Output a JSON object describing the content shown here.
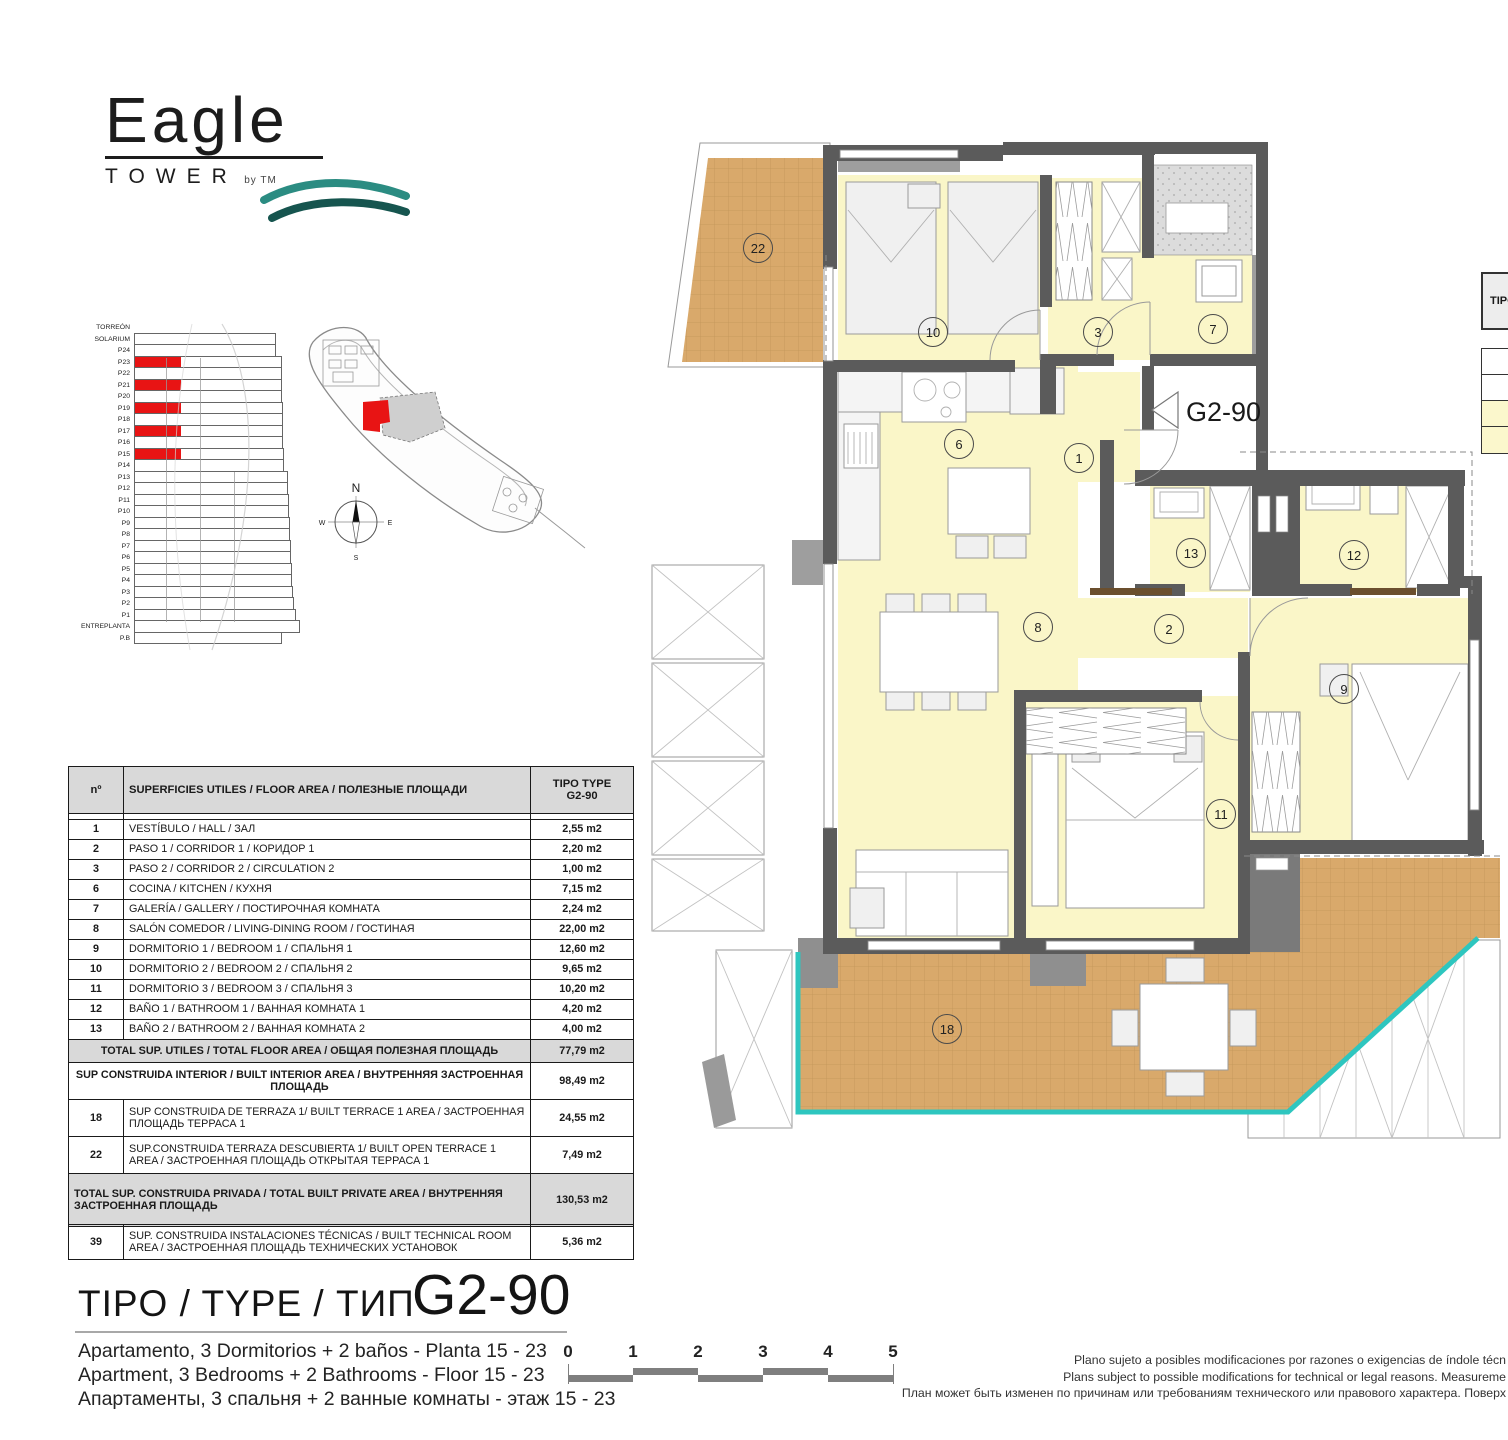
{
  "logo": {
    "name": "Eagle",
    "sub": "TOWER",
    "by": "by TM"
  },
  "elevation": {
    "floors": [
      {
        "label": "TORREÓN",
        "red": false
      },
      {
        "label": "SOLARIUM",
        "red": false
      },
      {
        "label": "P24",
        "red": false
      },
      {
        "label": "P23",
        "red": true
      },
      {
        "label": "P22",
        "red": false
      },
      {
        "label": "P21",
        "red": true
      },
      {
        "label": "P20",
        "red": false
      },
      {
        "label": "P19",
        "red": true
      },
      {
        "label": "P18",
        "red": false
      },
      {
        "label": "P17",
        "red": true
      },
      {
        "label": "P16",
        "red": false
      },
      {
        "label": "P15",
        "red": true
      },
      {
        "label": "P14",
        "red": false
      },
      {
        "label": "P13",
        "red": false
      },
      {
        "label": "P12",
        "red": false
      },
      {
        "label": "P11",
        "red": false
      },
      {
        "label": "P10",
        "red": false
      },
      {
        "label": "P9",
        "red": false
      },
      {
        "label": "P8",
        "red": false
      },
      {
        "label": "P7",
        "red": false
      },
      {
        "label": "P6",
        "red": false
      },
      {
        "label": "P5",
        "red": false
      },
      {
        "label": "P4",
        "red": false
      },
      {
        "label": "P3",
        "red": false
      },
      {
        "label": "P2",
        "red": false
      },
      {
        "label": "P1",
        "red": false
      },
      {
        "label": "ENTREPLANTA",
        "red": false
      },
      {
        "label": "P.B",
        "red": false
      }
    ]
  },
  "site": {
    "compass": {
      "n": "N",
      "e": "E",
      "s": "S",
      "w": "W"
    }
  },
  "area_table": {
    "col_no": "nº",
    "col_desc": "SUPERFICIES UTILES / FLOOR AREA / ПОЛЕЗНЫЕ ПЛОЩАДИ",
    "col_type": "TIPO TYPE",
    "col_type2": "G2-90",
    "rows": [
      {
        "no": "1",
        "desc": "VESTÍBULO / HALL / ЗАЛ",
        "val": "2,55 m2"
      },
      {
        "no": "2",
        "desc": "PASO 1 /  CORRIDOR 1 / КОРИДОР 1",
        "val": "2,20 m2"
      },
      {
        "no": "3",
        "desc": "PASO 2 / CORRIDOR 2 / CIRCULATION 2",
        "val": "1,00 m2"
      },
      {
        "no": "6",
        "desc": "COCINA / KITCHEN / КУХНЯ",
        "val": "7,15 m2"
      },
      {
        "no": "7",
        "desc": "GALERÍA / GALLERY / ПОСТИРОЧНАЯ КОМНАТА",
        "val": "2,24 m2"
      },
      {
        "no": "8",
        "desc": "SALÓN COMEDOR  / LIVING-DINING ROOM / ГОСТИНАЯ",
        "val": "22,00 m2"
      },
      {
        "no": "9",
        "desc": "DORMITORIO 1 / BEDROOM 1 / СПАЛЬНЯ 1",
        "val": "12,60 m2"
      },
      {
        "no": "10",
        "desc": "DORMITORIO 2 / BEDROOM 2 / СПАЛЬНЯ 2",
        "val": "9,65 m2"
      },
      {
        "no": "11",
        "desc": "DORMITORIO 3 / BEDROOM 3 / СПАЛЬНЯ 3",
        "val": "10,20 m2"
      },
      {
        "no": "12",
        "desc": "BAÑO 1 / BATHROOM 1 / ВАННАЯ КОМНАТА 1",
        "val": "4,20 m2"
      },
      {
        "no": "13",
        "desc": "BAÑO 2 / BATHROOM 2 / ВАННАЯ КОМНАТА 2",
        "val": "4,00 m2"
      }
    ],
    "total_utiles": {
      "desc": "TOTAL SUP. UTILES / TOTAL FLOOR AREA / ОБЩАЯ ПОЛЕЗНАЯ ПЛОЩАДЬ",
      "val": "77,79 m2"
    },
    "interior": {
      "desc": "SUP CONSTRUIDA INTERIOR / BUILT INTERIOR AREA / ВНУТРЕННЯЯ ЗАСТРОЕННАЯ ПЛОЩАДЬ",
      "val": "98,49 m2"
    },
    "terrace_rows": [
      {
        "no": "18",
        "desc": "SUP CONSTRUIDA DE TERRAZA 1/ BUILT TERRACE 1 AREA / ЗАСТРОЕННАЯ ПЛОЩАДЬ ТЕРРАСА  1",
        "val": "24,55 m2"
      },
      {
        "no": "22",
        "desc": "SUP.CONSTRUIDA TERRAZA DESCUBIERTA 1/ BUILT OPEN TERRACE 1 AREA / ЗАСТРОЕННАЯ ПЛОЩАДЬ ОТКРЫТАЯ ТЕРРАСА  1",
        "val": "7,49 m2"
      }
    ],
    "total_privada": {
      "desc": "TOTAL SUP. CONSTRUIDA PRIVADA / TOTAL  BUILT PRIVATE AREA / ВНУТРЕННЯЯ ЗАСТРОЕННАЯ ПЛОЩАДЬ",
      "val": "130,53 m2"
    },
    "technical": {
      "no": "39",
      "desc": "SUP. CONSTRUIDA INSTALACIONES TÉCNICAS / BUILT TECHNICAL ROOM AREA / ЗАСТРОЕННАЯ ПЛОЩАДЬ ТЕХНИЧЕСКИХ УСТАНОВОК",
      "val": "5,36 m2"
    }
  },
  "plan": {
    "unit_label": "G2-90",
    "rooms": [
      {
        "n": "22"
      },
      {
        "n": "10"
      },
      {
        "n": "3"
      },
      {
        "n": "7"
      },
      {
        "n": "6"
      },
      {
        "n": "1"
      },
      {
        "n": "13"
      },
      {
        "n": "12"
      },
      {
        "n": "8"
      },
      {
        "n": "2"
      },
      {
        "n": "9"
      },
      {
        "n": "11"
      },
      {
        "n": "18"
      }
    ]
  },
  "fragment_table": {
    "header": "TIPO"
  },
  "footer": {
    "type_label": "TIPO / TYPE / ТИП",
    "type_code": "G2-90",
    "desc_es": "Apartamento, 3 Dormitorios + 2 baños - Planta 15 - 23",
    "desc_en": "Apartment, 3 Bedrooms + 2 Bathrooms - Floor 15 - 23",
    "desc_ru": "Апартаменты, 3 спальня + 2 ванные комнаты - этаж 15 - 23"
  },
  "scale_bar": {
    "ticks": [
      "0",
      "1",
      "2",
      "3",
      "4",
      "5"
    ]
  },
  "disclaimer": {
    "line_es": "Plano sujeto a posibles modificaciones por razones o exigencias de índole técn",
    "line_en": "Plans subject to possible modifications for technical or legal reasons. Measureme",
    "line_ru": "План может быть изменен по причинам или требованиям технического или правового характера. Поверх"
  },
  "colors": {
    "accent_red": "#e81414",
    "terrace_tan": "#d9a96b",
    "room_yellow": "#faf6c8",
    "wall_gray": "#5b5b5b",
    "balustrade_teal": "#2ec6bf",
    "wave_teal": "#2b8c82",
    "wave_dark": "#16554f"
  }
}
